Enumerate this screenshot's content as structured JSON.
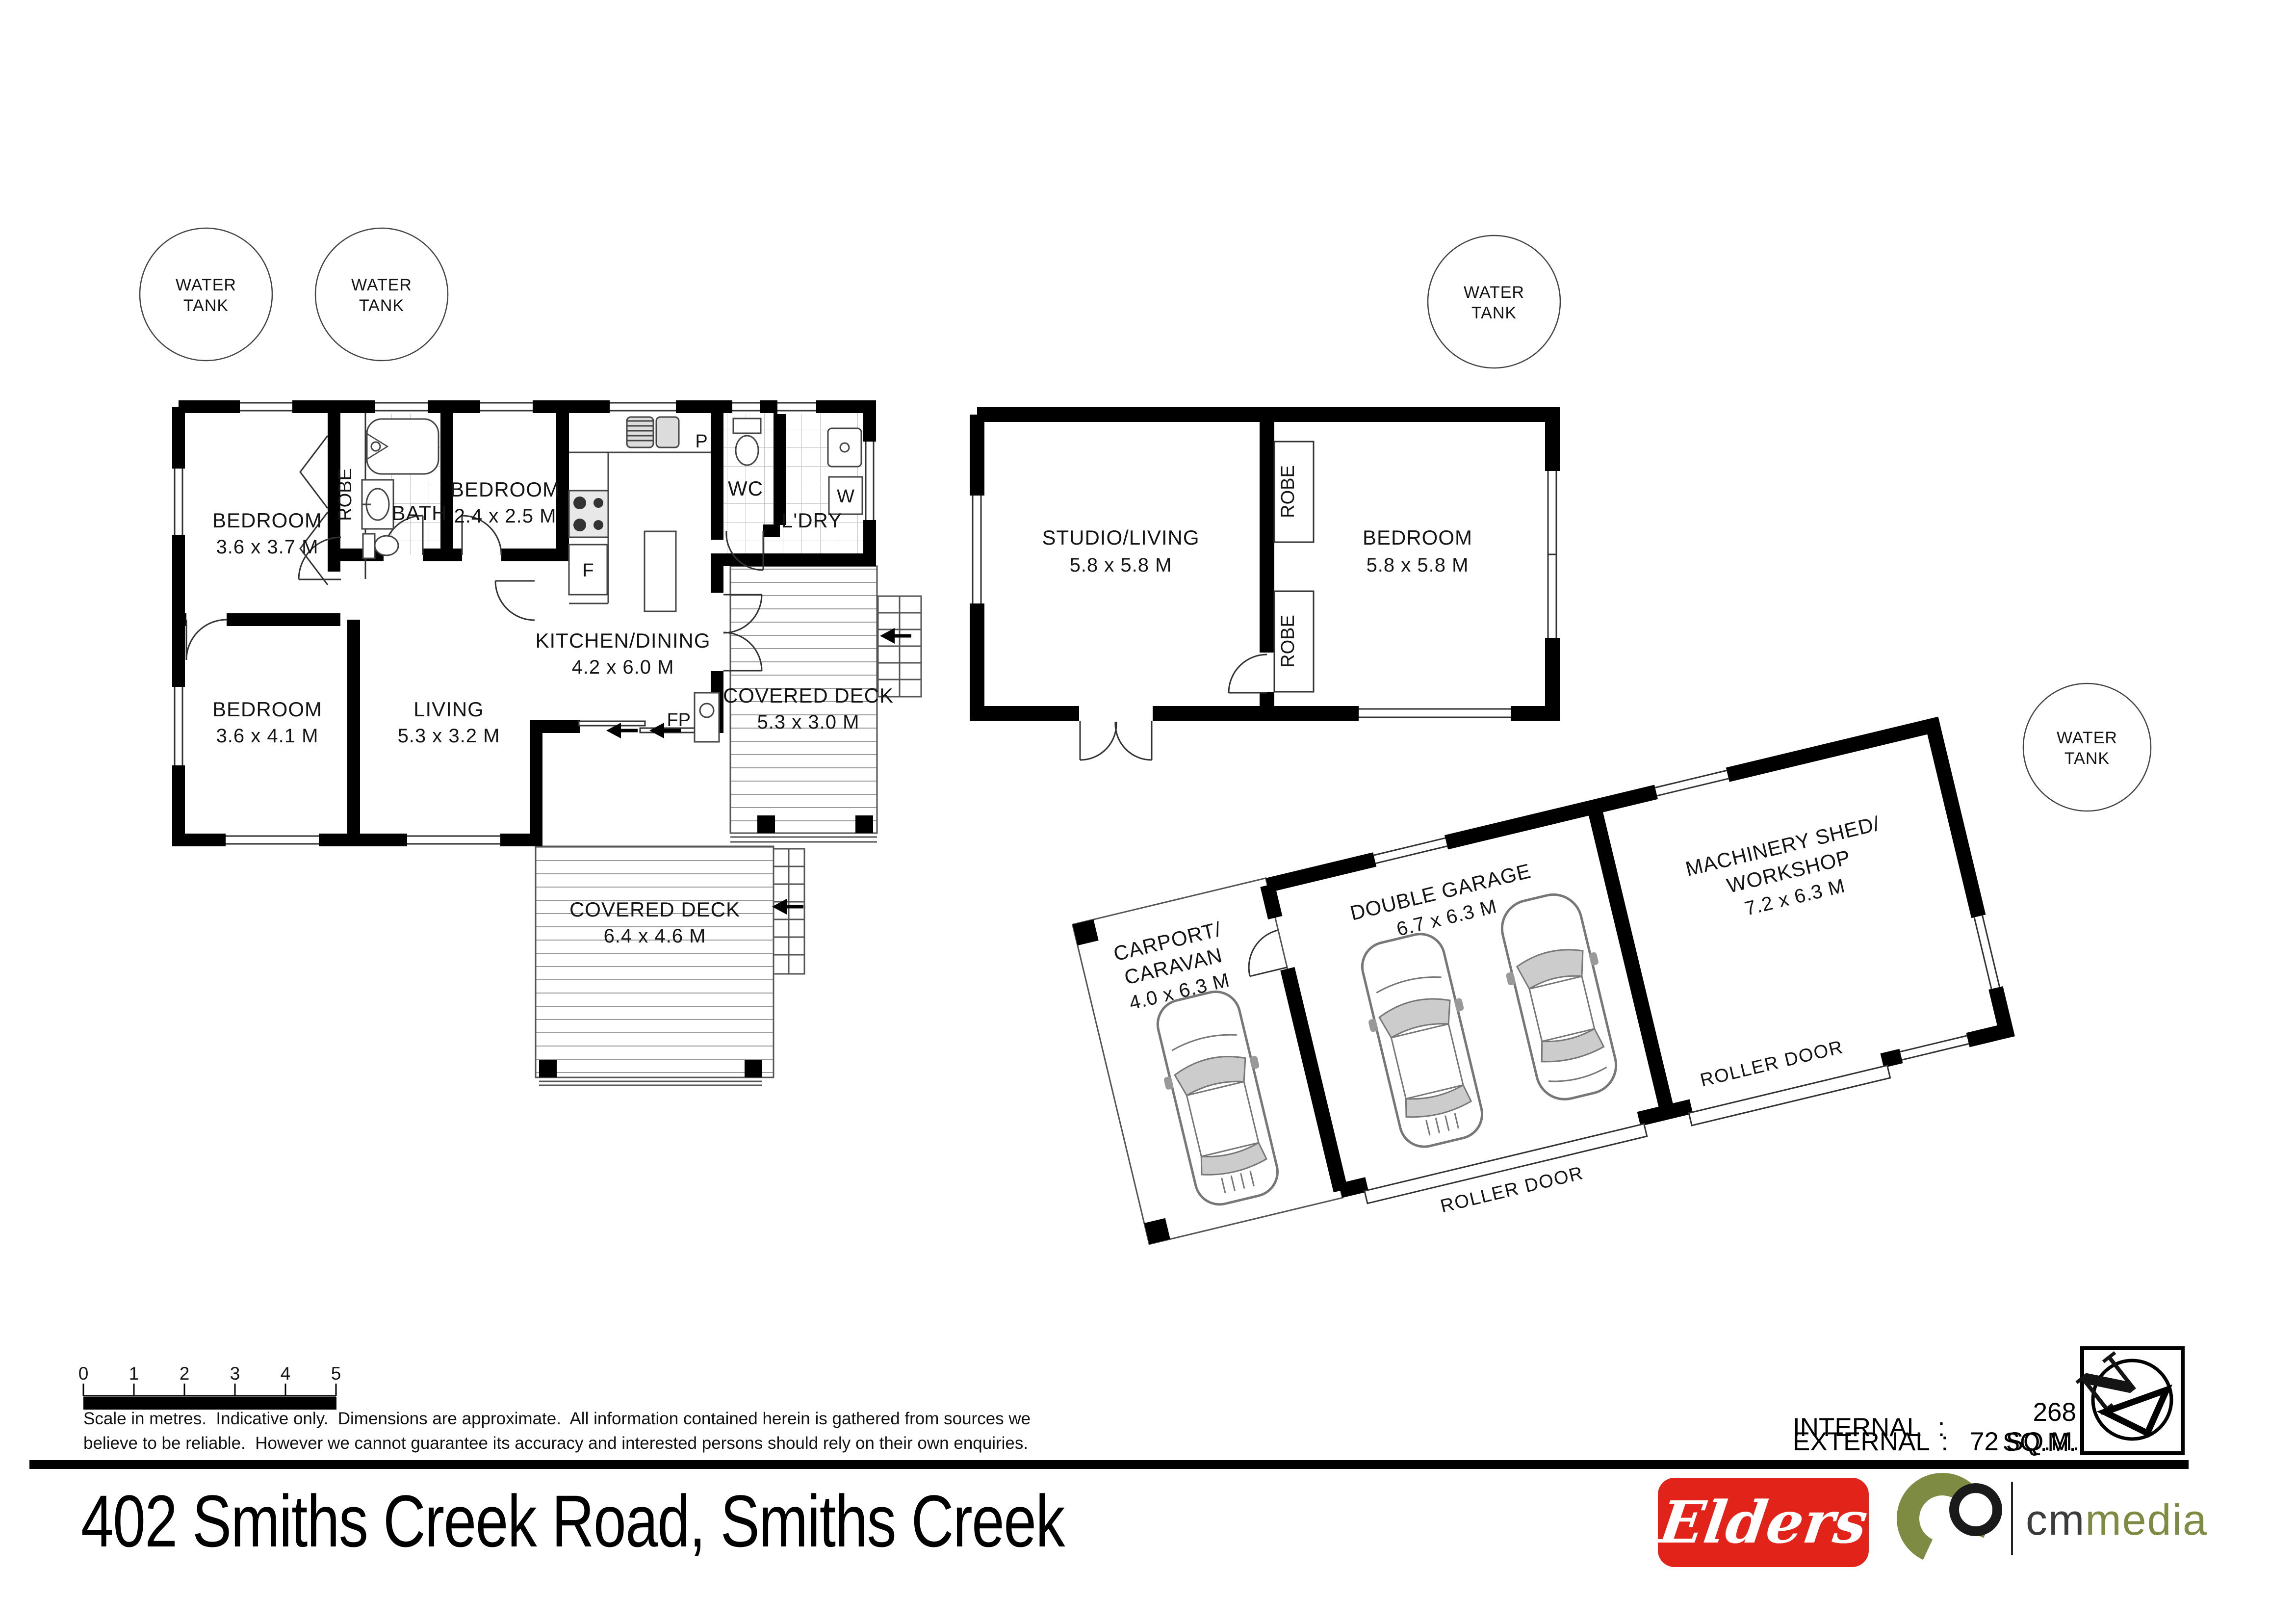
{
  "title": "402 Smiths Creek Road, Smiths Creek",
  "tanks": {
    "line1": "WATER",
    "line2": "TANK"
  },
  "house": {
    "bedroom1_name": "BEDROOM",
    "bedroom1_dims": "3.6 x 3.7 M",
    "robe": "ROBE",
    "bath": "BATH",
    "bedroom2_name": "BEDROOM",
    "bedroom2_dims": "2.4 x 2.5 M",
    "wc": "WC",
    "ldry": "L'DRY",
    "pantry": "P",
    "fridge": "F",
    "washer": "W",
    "fireplace": "FP",
    "kitchen_name": "KITCHEN/DINING",
    "kitchen_dims": "4.2 x 6.0 M",
    "bedroom3_name": "BEDROOM",
    "bedroom3_dims": "3.6 x 4.1 M",
    "living_name": "LIVING",
    "living_dims": "5.3 x 3.2 M",
    "deck1_name": "COVERED DECK",
    "deck1_dims": "5.3 x 3.0 M",
    "deck2_name": "COVERED DECK",
    "deck2_dims": "6.4 x 4.6 M"
  },
  "studio": {
    "studio_name": "STUDIO/LIVING",
    "studio_dims": "5.8 x 5.8 M",
    "bedroom_name": "BEDROOM",
    "bedroom_dims": "5.8 x 5.8 M",
    "robe1": "ROBE",
    "robe2": "ROBE"
  },
  "garage": {
    "carport_name1": "CARPORT/",
    "carport_name2": "CARAVAN",
    "carport_dims": "4.0 x 6.3 M",
    "garage_name": "DOUBLE GARAGE",
    "garage_dims": "6.7 x 6.3 M",
    "shed_name1": "MACHINERY SHED/",
    "shed_name2": "WORKSHOP",
    "shed_dims": "7.2 x 6.3 M",
    "roller_door_1": "ROLLER DOOR",
    "roller_door_2": "ROLLER DOOR"
  },
  "scale_bar": {
    "ticks": [
      "0",
      "1",
      "2",
      "3",
      "4",
      "5"
    ]
  },
  "disclaimer": {
    "line1": "Scale in metres.  Indicative only.  Dimensions are approximate.  All information contained herein is gathered from sources we",
    "line2": "believe to be reliable.  However we cannot guarantee its accuracy and interested persons should rely on their own enquiries."
  },
  "areas": {
    "internal_label": "INTERNAL",
    "internal_value": "268 SQ.M.",
    "external_label": "EXTERNAL",
    "external_value": "72 SQ.M.",
    "separator": ":"
  },
  "north": {
    "letter": "N"
  },
  "logos": {
    "elders": "Elders",
    "cm": "cm",
    "media": "media"
  },
  "colors": {
    "elders_red": "#e2231a",
    "media_olive": "#7d8c42",
    "wall_black": "#000000"
  }
}
